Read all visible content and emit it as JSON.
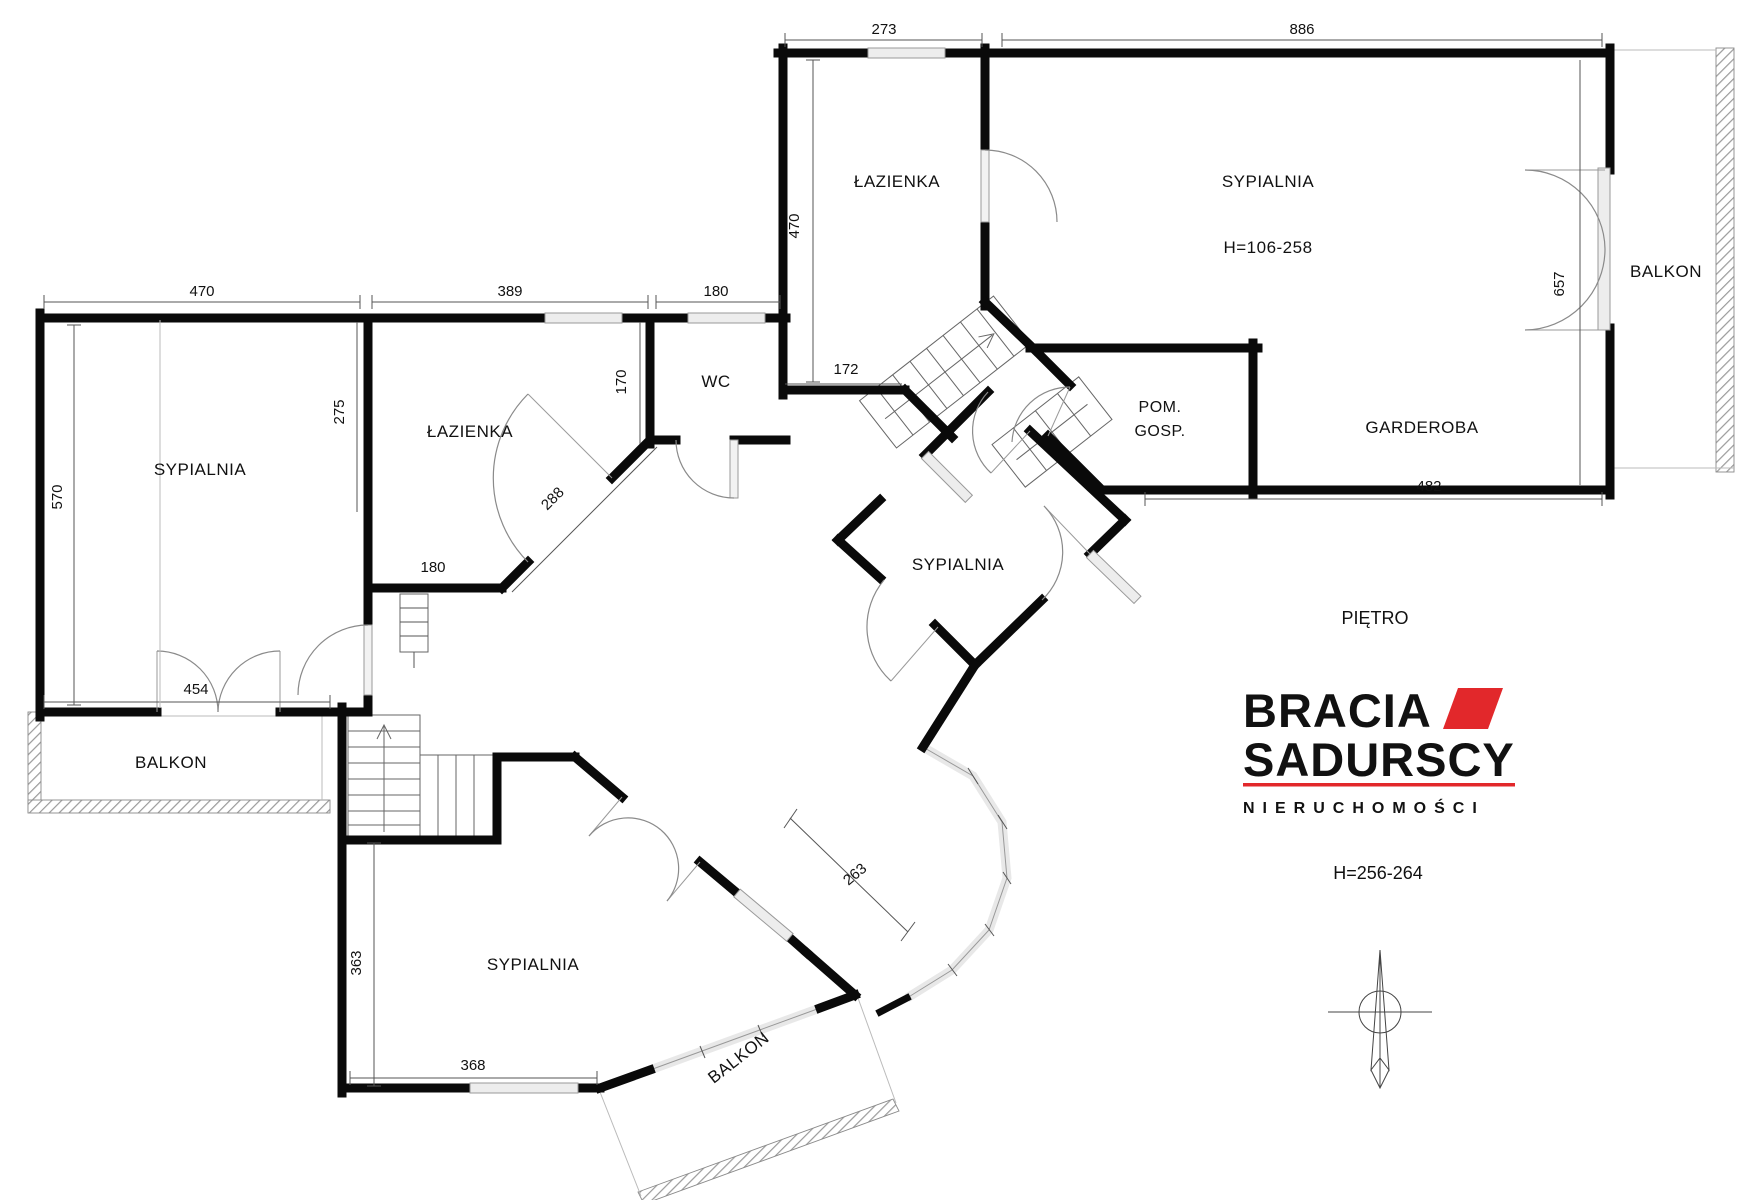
{
  "plan": {
    "floor_label": "PIĘTRO",
    "height_note": "H=256-264",
    "rooms": {
      "lazienka_top": "ŁAZIENKA",
      "sypialnia_main": "SYPIALNIA",
      "sypialnia_main_height": "H=106-258",
      "balkon_right": "BALKON",
      "garderoba": "GARDEROBA",
      "pom_gosp_line1": "POM.",
      "pom_gosp_line2": "GOSP.",
      "sypialnia_middle": "SYPIALNIA",
      "wc": "WC",
      "lazienka_left": "ŁAZIENKA",
      "sypialnia_left": "SYPIALNIA",
      "balkon_left": "BALKON",
      "sypialnia_bottom": "SYPIALNIA",
      "balkon_bottom": "BALKON"
    },
    "dimensions": {
      "top_bath_width": "273",
      "main_bedroom_width": "886",
      "left_bedroom_width": "470",
      "left_bath_width": "389",
      "wc_width": "180",
      "top_bath_height": "470",
      "balcony_door_height": "657",
      "left_bedroom_height": "570",
      "left_bedroom_inner": "275",
      "wc_inner": "170",
      "top_bath_bottom": "172",
      "left_bath_chamfer": "288",
      "left_bath_bottom": "180",
      "balcony_left_width": "454",
      "garderoba_width": "482",
      "bottom_bedroom_height": "363",
      "bottom_bedroom_width": "368",
      "alcove_width": "263"
    }
  },
  "logo": {
    "line1": "BRACIA",
    "line2": "SADURSCY",
    "line3": "NIERUCHOMOŚCI",
    "accent_color": "#E2282B",
    "text_color": "#2E2D33"
  }
}
